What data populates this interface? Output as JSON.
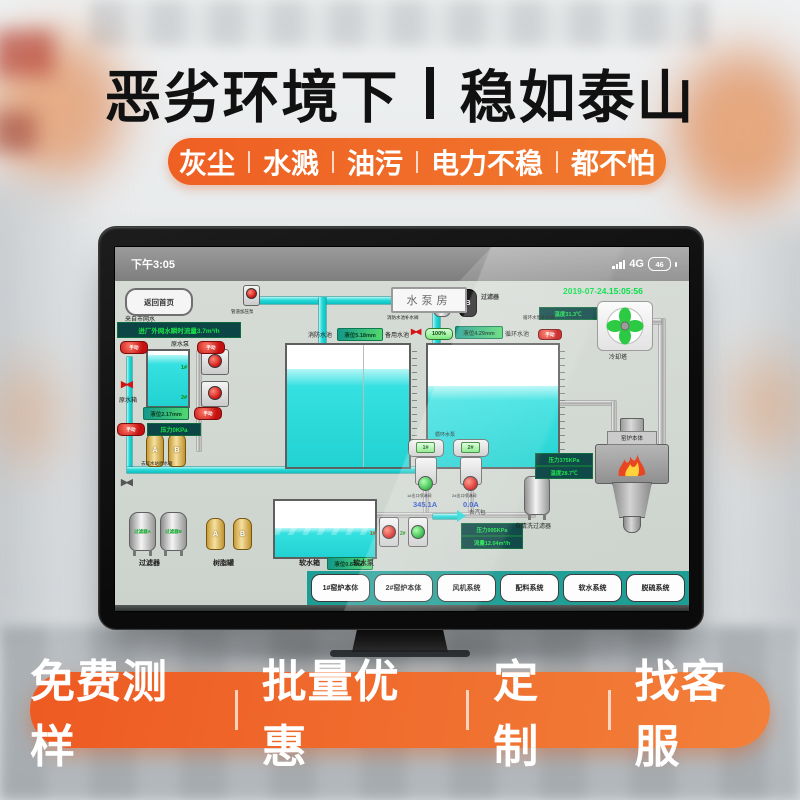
{
  "colors": {
    "accent_orange": "#ef5f23",
    "teal_bar": "#1d9d94",
    "led_green": "#1ae24a",
    "water_cyan": "#35e0e0",
    "date_green": "#00dd45",
    "alarm_red": "#d01212"
  },
  "header": {
    "title_left": "恶劣环境下",
    "title_right": "稳如泰山",
    "features": [
      "灰尘",
      "水溅",
      "油污",
      "电力不稳",
      "都不怕"
    ]
  },
  "footer": {
    "items": [
      "免费测样",
      "批量优惠",
      "定制",
      "找客服"
    ]
  },
  "tablet": {
    "statusbar": {
      "time": "下午3:05",
      "network": "4G",
      "battery": "46"
    },
    "scada": {
      "home_button": "返回首页",
      "source_label": "来自市网水",
      "inflow_value": "进厂外网水瞬时流量3.7m³/h",
      "room_title": "水泵房",
      "datetime": "2019-07-24.15:05:56",
      "duct_pump_label": "管道加压泵",
      "top_filter": {
        "a": "A",
        "b": "B",
        "label": "过滤器"
      },
      "cooling": {
        "label": "冷却塔",
        "temp": "温度31.3℃"
      },
      "pools": {
        "fire_label": "消防水池",
        "fire_level": "液位5.18mm",
        "spare_label": "备用水池",
        "fill_valve_label": "消防水池补水阀",
        "fill_valve_status": "100%",
        "circ_level": "液位4.29mm",
        "circ_label": "循环水池",
        "circ_valve_label": "循环水泵补水阀",
        "mode_badge": "手动"
      },
      "raw": {
        "mode_badge": "手动",
        "pump_label": "原水泵",
        "pump1": "1#",
        "pump2": "2#",
        "tank_label": "原水箱",
        "level": "液位2.17mm",
        "pressure": "压力0KPa"
      },
      "soften": {
        "vessel_a": "A",
        "vessel_b": "B",
        "to_station_label": "去软水站原水箱",
        "filter_a_text": "过滤器A",
        "filter_b_text": "过滤器B",
        "filters_label": "过滤器",
        "resin_label": "树脂罐"
      },
      "soft": {
        "tank_label": "软水箱",
        "level": "液位0.87mm",
        "pump_label": "软水泵",
        "pump1": "1#",
        "pump2": "2#",
        "pressure": "压力995KPa",
        "flow": "流量12.04m³/h",
        "to_drum_label": "去汽包"
      },
      "circ_pump": {
        "label": "循环水泵",
        "pump1": "1#",
        "pump2": "2#",
        "valve1_label": "1#出口喷淋阀",
        "valve1_value": "345.1A",
        "valve2_label": "2#出口喷淋阀",
        "valve2_value": "0.0A",
        "self_clean_label": "自清洗过滤器"
      },
      "boiler": {
        "label": "窑炉本体",
        "pressure": "压力375KPa",
        "temp": "温度28.7℃"
      },
      "nav": [
        "1#窑炉本体",
        "2#窑炉本体",
        "风机系统",
        "配料系统",
        "软水系统",
        "脱硫系统"
      ]
    }
  }
}
